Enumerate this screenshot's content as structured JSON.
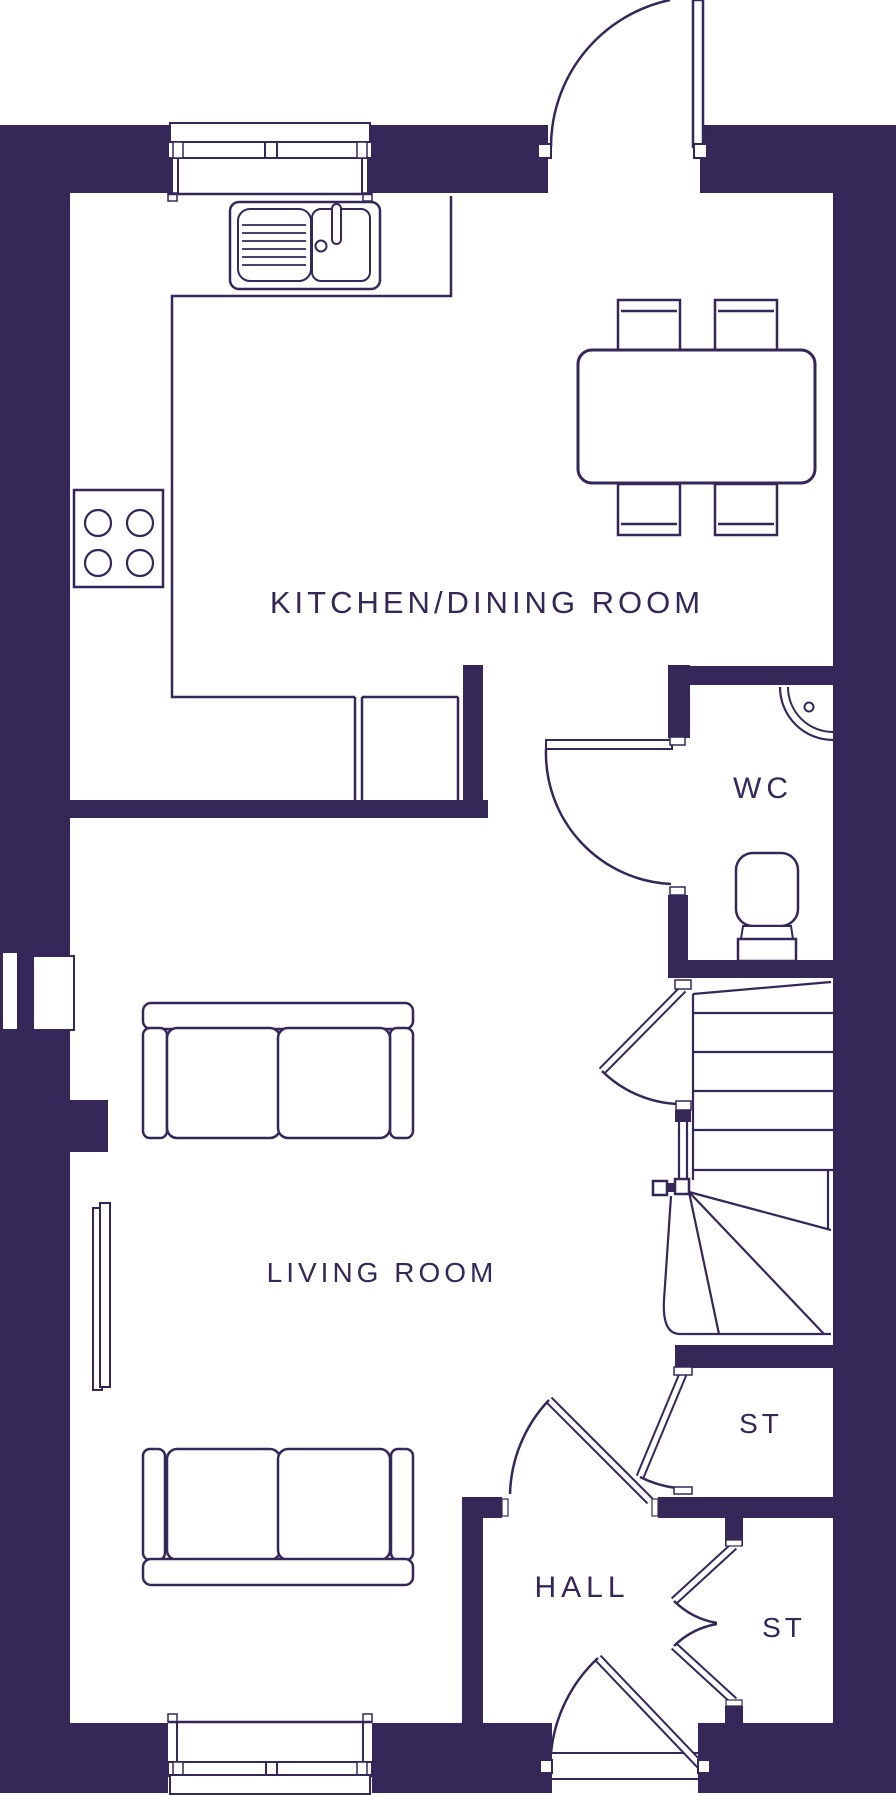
{
  "colors": {
    "ink": "#352758",
    "paper": "#ffffff"
  },
  "plan": {
    "type": "floorplan-ground-floor",
    "labels": {
      "kitchen_dining": "KITCHEN/DINING ROOM",
      "wc": "WC",
      "living_room": "LIVING ROOM",
      "hall": "HALL",
      "storage_upper": "ST",
      "storage_lower": "ST"
    }
  }
}
